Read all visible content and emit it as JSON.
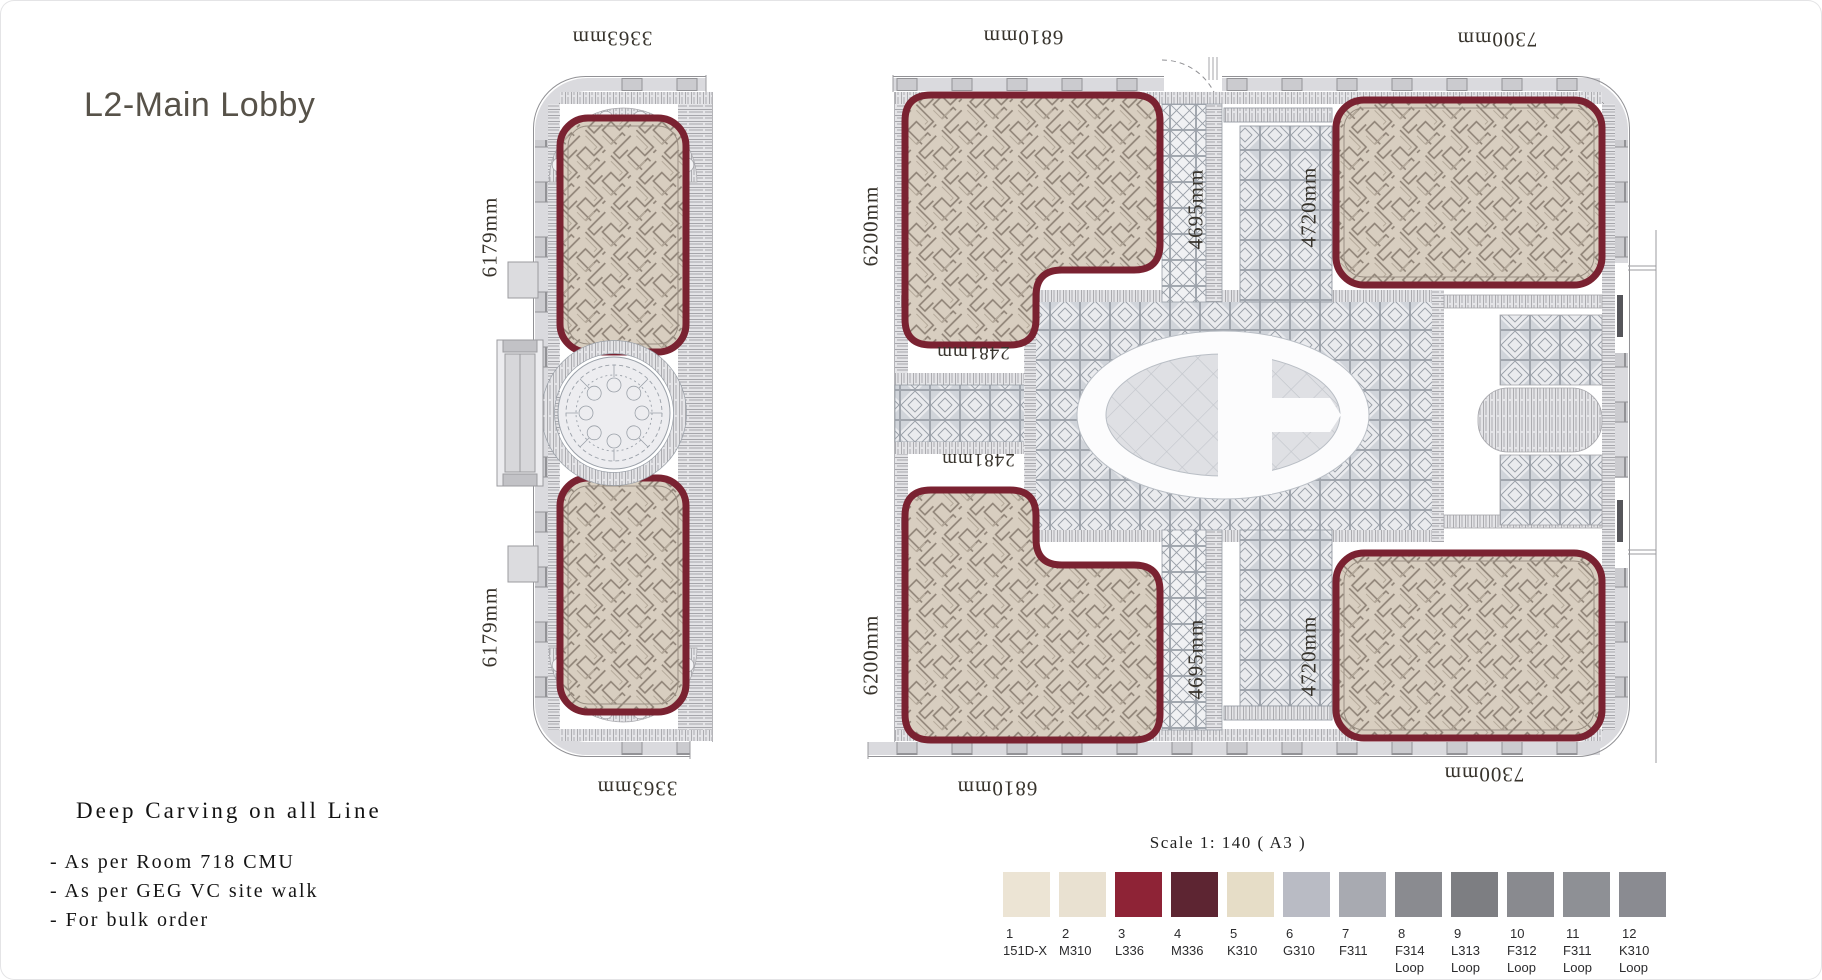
{
  "page": {
    "title": "L2-Main Lobby"
  },
  "notes": {
    "heading": "Deep Carving on all Line",
    "items": [
      "- As per Room 718 CMU",
      "- As per GEG VC site walk",
      "- For bulk order"
    ]
  },
  "scale_note": "Scale 1: 140 ( A3 )",
  "plan": {
    "dimensions": {
      "top_left": "3363mm",
      "top_middle": "6810mm",
      "top_right": "7300mm",
      "bottom_left": "3363mm",
      "bottom_middle": "6810mm",
      "bottom_right": "7300mm",
      "left_upper": "6179mm",
      "left_lower": "6179mm",
      "corridor_upper": "6200mm",
      "corridor_lower": "6200mm",
      "center_upper": "2481mm",
      "center_lower": "2481mm",
      "strip_upper": "4695mm",
      "strip_lower": "4695mm",
      "grid_upper": "4720mm",
      "grid_lower": "4720mm"
    },
    "palette": {
      "carpet_border": "#7a2231",
      "carpet_fill": "#d8cec0",
      "carpet_line": "#8c8074",
      "wall": "#dadade",
      "line": "#919195"
    }
  },
  "legend": {
    "items": [
      {
        "num": "1",
        "code": "151D-X",
        "sub": "",
        "color": "#ece4d4"
      },
      {
        "num": "2",
        "code": "M310",
        "sub": "",
        "color": "#e9e1d1"
      },
      {
        "num": "3",
        "code": "L336",
        "sub": "",
        "color": "#8e2336"
      },
      {
        "num": "4",
        "code": "M336",
        "sub": "",
        "color": "#5d2532"
      },
      {
        "num": "5",
        "code": "K310",
        "sub": "",
        "color": "#e6ddc7"
      },
      {
        "num": "6",
        "code": "G310",
        "sub": "",
        "color": "#b9bbc4"
      },
      {
        "num": "7",
        "code": "F311",
        "sub": "",
        "color": "#a8aab1"
      },
      {
        "num": "8",
        "code": "F314",
        "sub": "Loop",
        "color": "#8a8b90"
      },
      {
        "num": "9",
        "code": "L313",
        "sub": "Loop",
        "color": "#7d7e82"
      },
      {
        "num": "10",
        "code": "F312",
        "sub": "Loop",
        "color": "#898a8f"
      },
      {
        "num": "11",
        "code": "F311",
        "sub": "Loop",
        "color": "#8e9095"
      },
      {
        "num": "12",
        "code": "K310",
        "sub": "Loop",
        "color": "#8a8b91"
      }
    ]
  }
}
